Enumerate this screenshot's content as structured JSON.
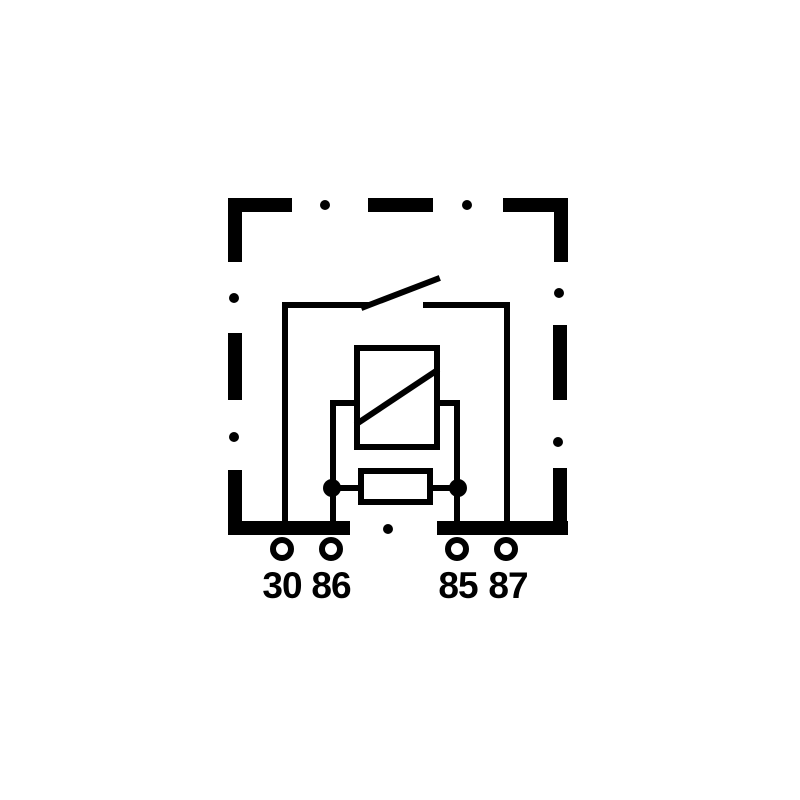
{
  "diagram": {
    "kind": "relay-internal-circuit-schematic",
    "colors": {
      "ink": "#000000",
      "background": "#ffffff"
    },
    "terminals": [
      {
        "id": "30",
        "label": "30"
      },
      {
        "id": "86",
        "label": "86"
      },
      {
        "id": "85",
        "label": "85"
      },
      {
        "id": "87",
        "label": "87"
      }
    ],
    "components": {
      "housing": "dash-dot-outline-box",
      "switch": "normally-open-contact",
      "coil": "coil-box-with-diagonal",
      "resistor": "parallel-resistor-box"
    }
  }
}
